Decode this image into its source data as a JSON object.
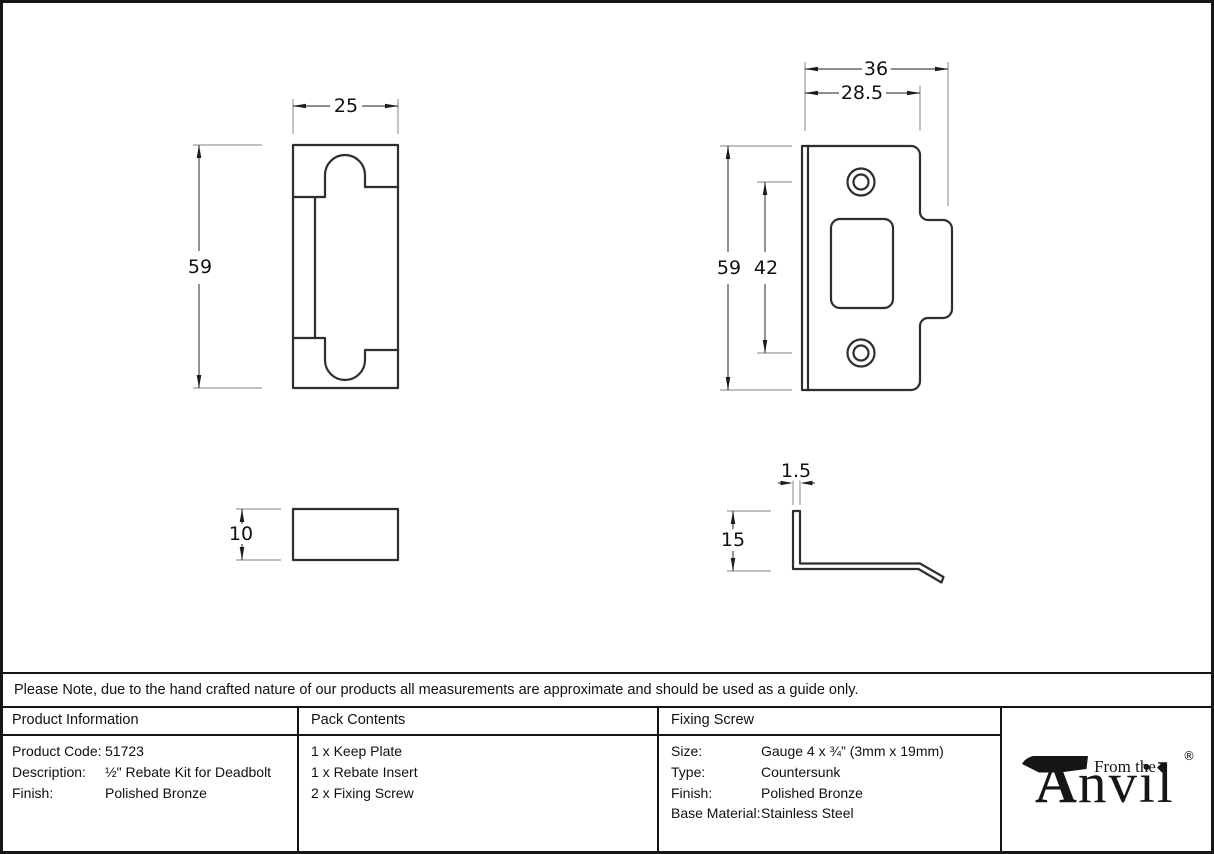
{
  "note": "Please Note, due to the hand crafted nature of our products all measurements are approximate and should be used as a guide only.",
  "drawings": {
    "insert_front": {
      "width": "25",
      "height": "59"
    },
    "keep_plate_front": {
      "overall_width": "36",
      "plate_width": "28.5",
      "height": "59",
      "screw_spacing": "42"
    },
    "insert_side": {
      "thickness": "10"
    },
    "keep_plate_side": {
      "lip_thickness": "1.5",
      "lip_height": "15"
    }
  },
  "table": {
    "product_information": {
      "header": "Product Information",
      "rows": [
        {
          "label": "Product Code:",
          "value": "51723"
        },
        {
          "label": "Description:",
          "value": "½\" Rebate Kit for Deadbolt"
        },
        {
          "label": "Finish:",
          "value": "Polished Bronze"
        }
      ]
    },
    "pack_contents": {
      "header": "Pack Contents",
      "items": [
        "1 x Keep Plate",
        "1 x Rebate Insert",
        "2 x Fixing Screw"
      ]
    },
    "fixing_screw": {
      "header": "Fixing Screw",
      "rows": [
        {
          "label": "Size:",
          "value": "Gauge 4 x ¾” (3mm x 19mm)"
        },
        {
          "label": "Type:",
          "value": "Countersunk"
        },
        {
          "label": "Finish:",
          "value": "Polished Bronze"
        },
        {
          "label": "Base Material:",
          "value": "Stainless Steel"
        }
      ]
    }
  },
  "logo": {
    "tagline": "From the",
    "brand_initial": "A",
    "brand_rest": "nvil",
    "diamond": "◆",
    "registered": "®"
  },
  "colors": {
    "outline": "#2e2e2e",
    "dimension_line": "#4a4a4a",
    "extension_line": "#9b9b9b",
    "text": "#111111",
    "background": "#ffffff"
  }
}
